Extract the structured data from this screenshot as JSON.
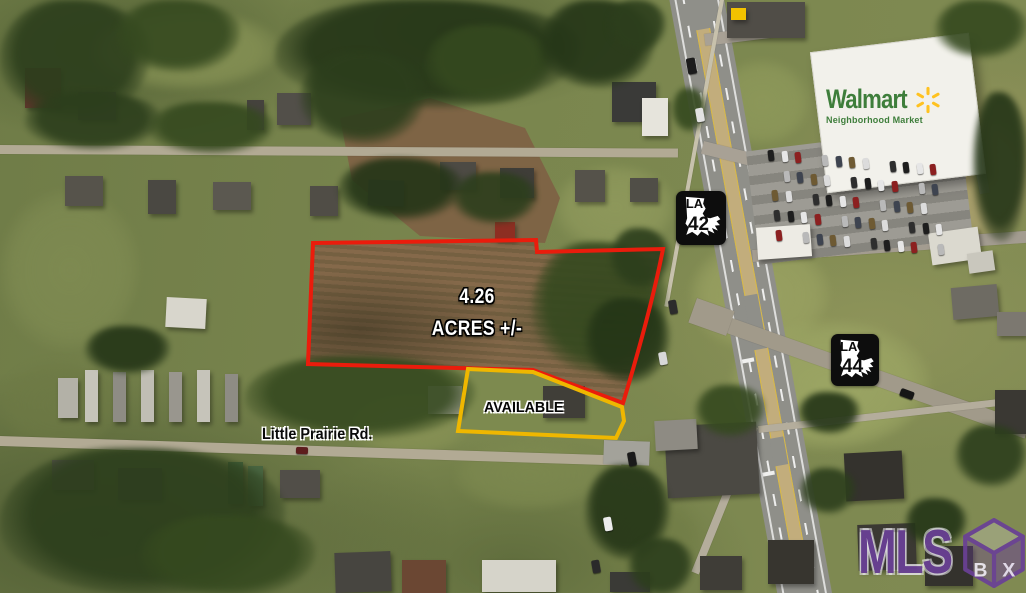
{
  "annotations": {
    "acreage": {
      "line1": "4.26",
      "line2": "ACRES +/-"
    },
    "available": "AVAILABLE",
    "street": "Little Prairie Rd."
  },
  "route_shields": [
    {
      "state": "LA",
      "number": "42"
    },
    {
      "state": "LA",
      "number": "44"
    }
  ],
  "store_sign": {
    "brand": "Walmart",
    "subtitle": "Neighborhood Market"
  },
  "watermark": {
    "letters": "MLS",
    "cube_letter_left": "B",
    "cube_letter_right": "X"
  },
  "colors": {
    "boundary_red": "#EA1C0C",
    "boundary_yellow": "#EFB700",
    "walmart_green": "#3E7E3B",
    "walmart_spark": "#FFC220",
    "mls_purple": "#6A4096"
  }
}
